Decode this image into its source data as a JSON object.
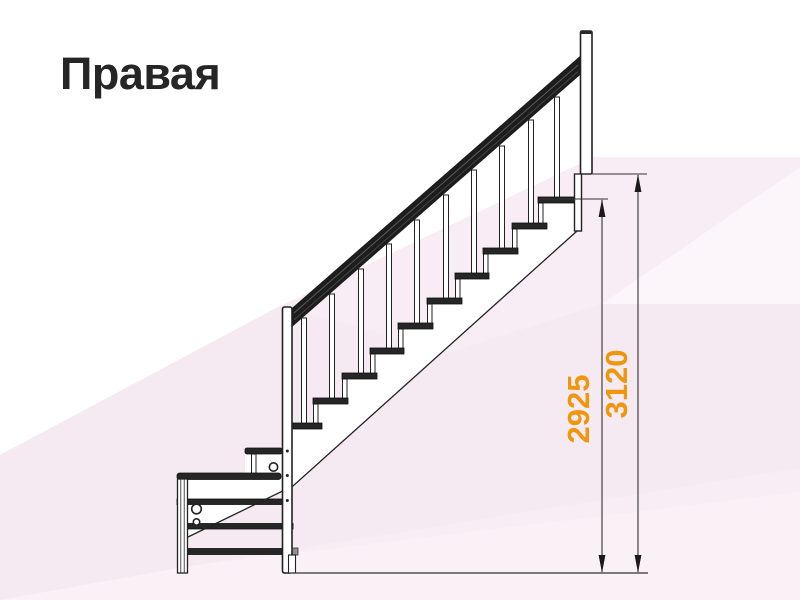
{
  "title": "Правая",
  "diagram": {
    "dimensions": {
      "landing_height": "2925",
      "total_height": "3120"
    }
  },
  "colors": {
    "dimension_text": "#f0960d",
    "line_color": "#222222",
    "title_color": "#262626",
    "background_tint": "#f8edf5",
    "handrail_color": "#1d1d1d"
  }
}
